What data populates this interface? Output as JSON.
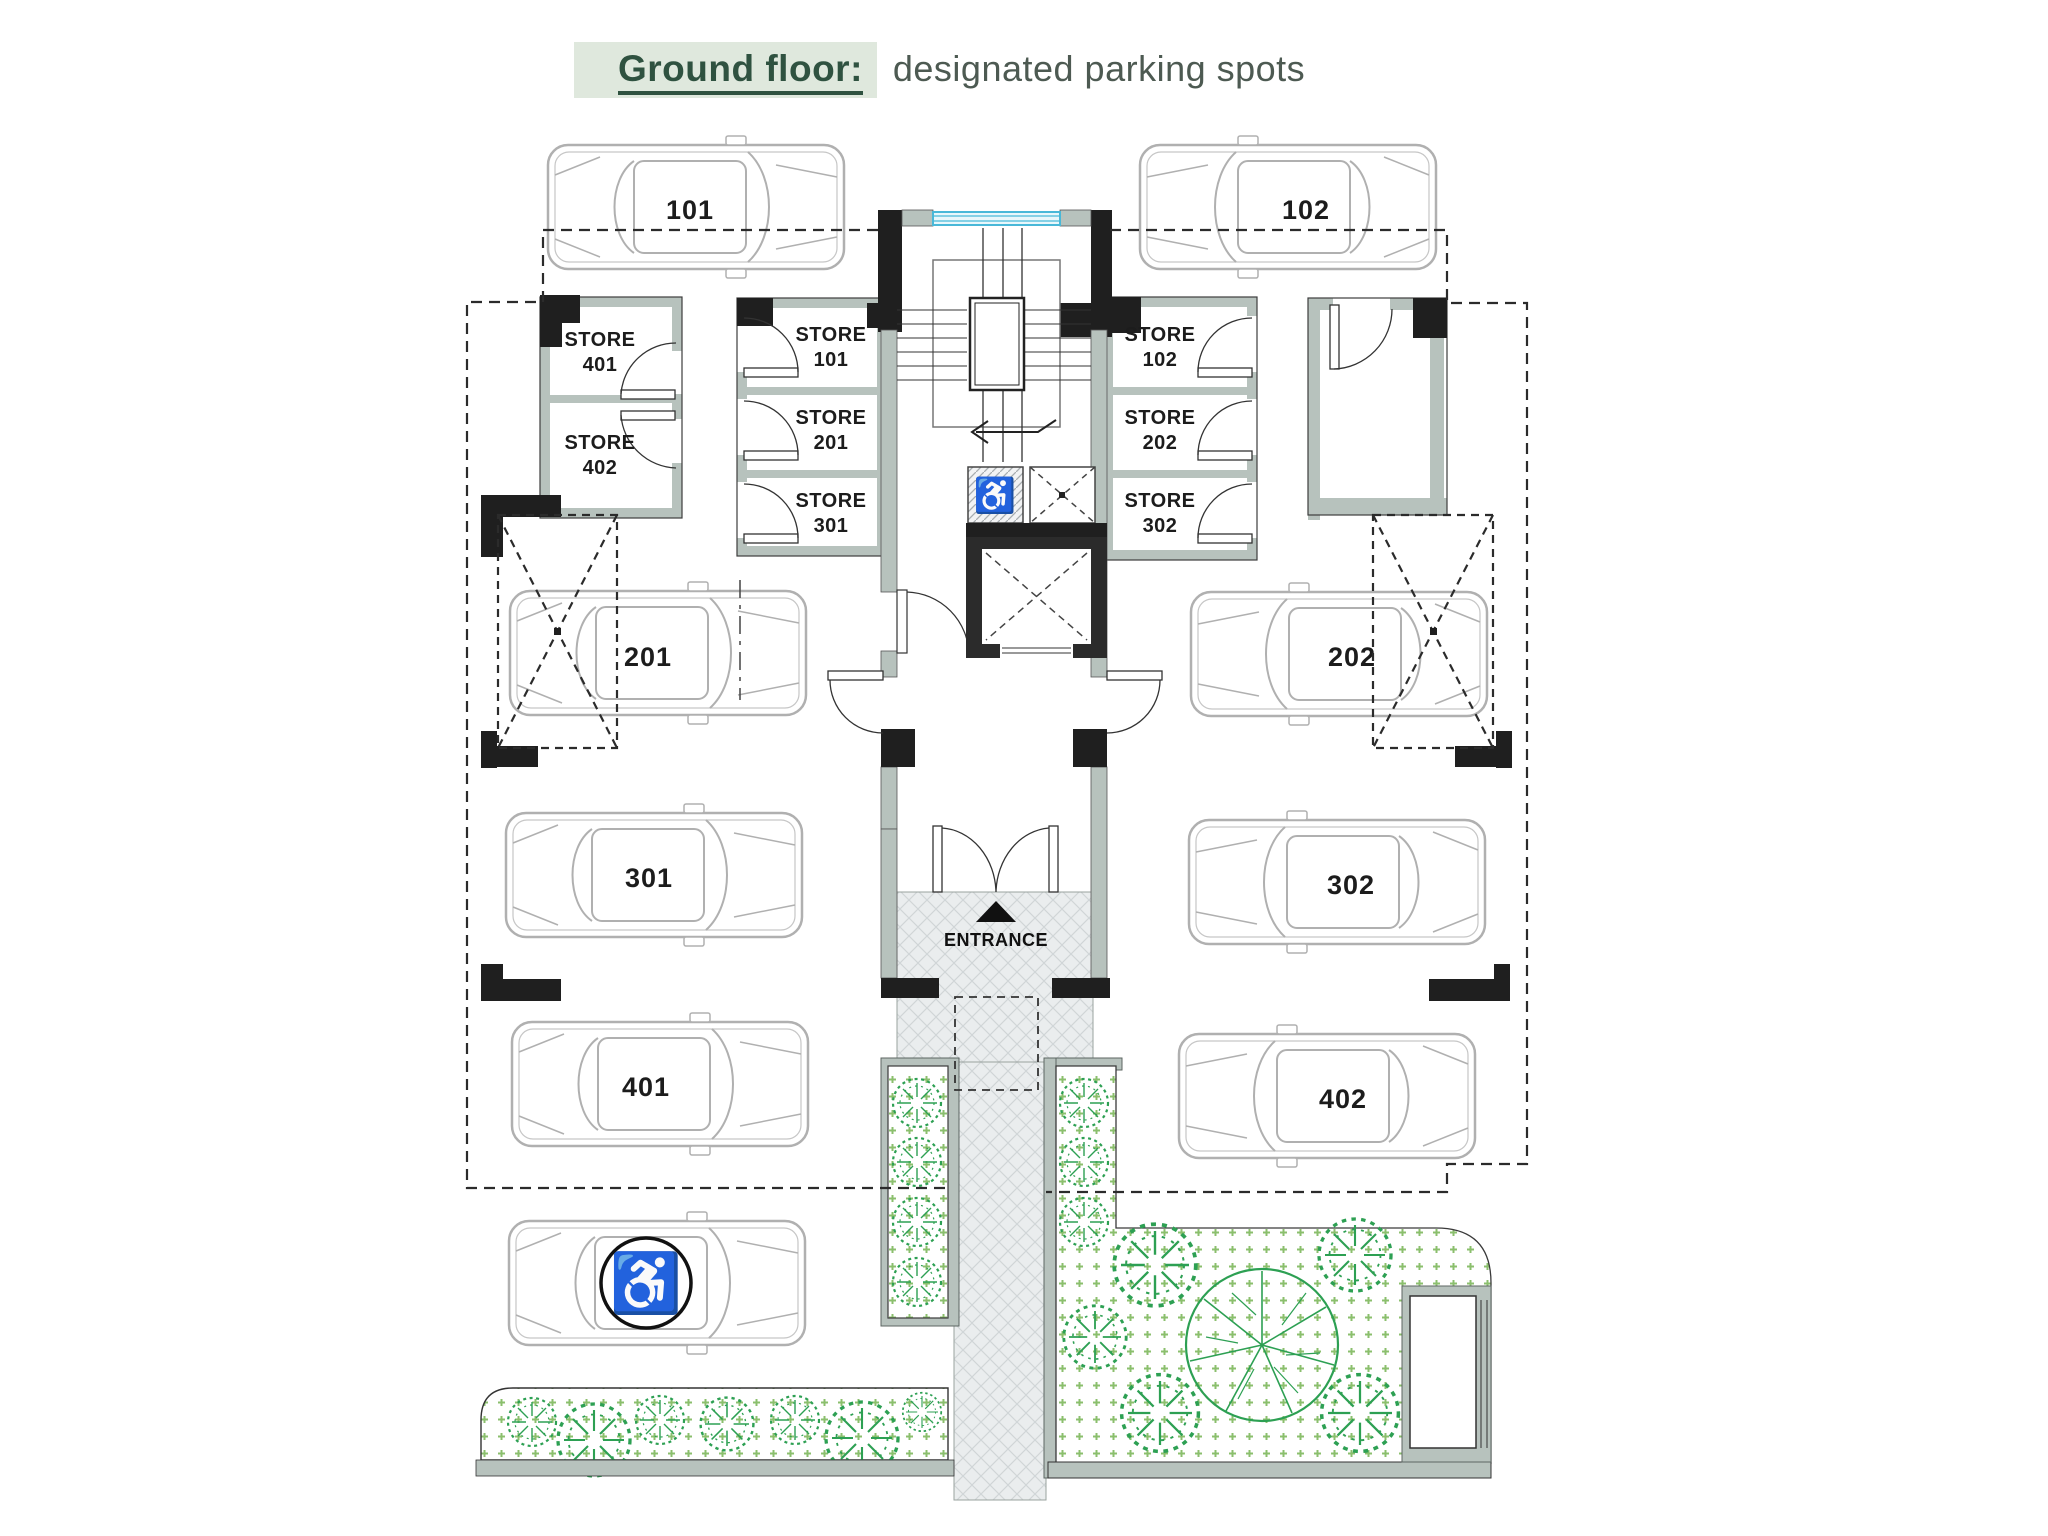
{
  "title": {
    "highlight": "Ground floor:",
    "subtitle": "designated parking spots"
  },
  "entrance": {
    "label": "ENTRANCE"
  },
  "parking_spots": [
    {
      "id": "101",
      "label": "101"
    },
    {
      "id": "102",
      "label": "102"
    },
    {
      "id": "201",
      "label": "201"
    },
    {
      "id": "202",
      "label": "202"
    },
    {
      "id": "301",
      "label": "301"
    },
    {
      "id": "302",
      "label": "302"
    },
    {
      "id": "401",
      "label": "401"
    },
    {
      "id": "402",
      "label": "402"
    },
    {
      "id": "accessible",
      "label": "",
      "icon": "wheelchair-icon"
    }
  ],
  "stores": [
    {
      "name": "STORE",
      "number": "401"
    },
    {
      "name": "STORE",
      "number": "402"
    },
    {
      "name": "STORE",
      "number": "101"
    },
    {
      "name": "STORE",
      "number": "201"
    },
    {
      "name": "STORE",
      "number": "301"
    },
    {
      "name": "STORE",
      "number": "102"
    },
    {
      "name": "STORE",
      "number": "202"
    },
    {
      "name": "STORE",
      "number": "302"
    }
  ],
  "icons": {
    "wheelchair": "♿"
  },
  "colors": {
    "title_green": "#2f5240",
    "title_highlight_bg": "#dfe8dd",
    "subtitle_gray": "#4d5a52",
    "wall_black": "#1f1f1f",
    "wall_gray": "#b7c2bd",
    "window_cyan": "#49b8d8",
    "plant_green": "#2da053",
    "car_line_gray": "#b0b0b0"
  }
}
